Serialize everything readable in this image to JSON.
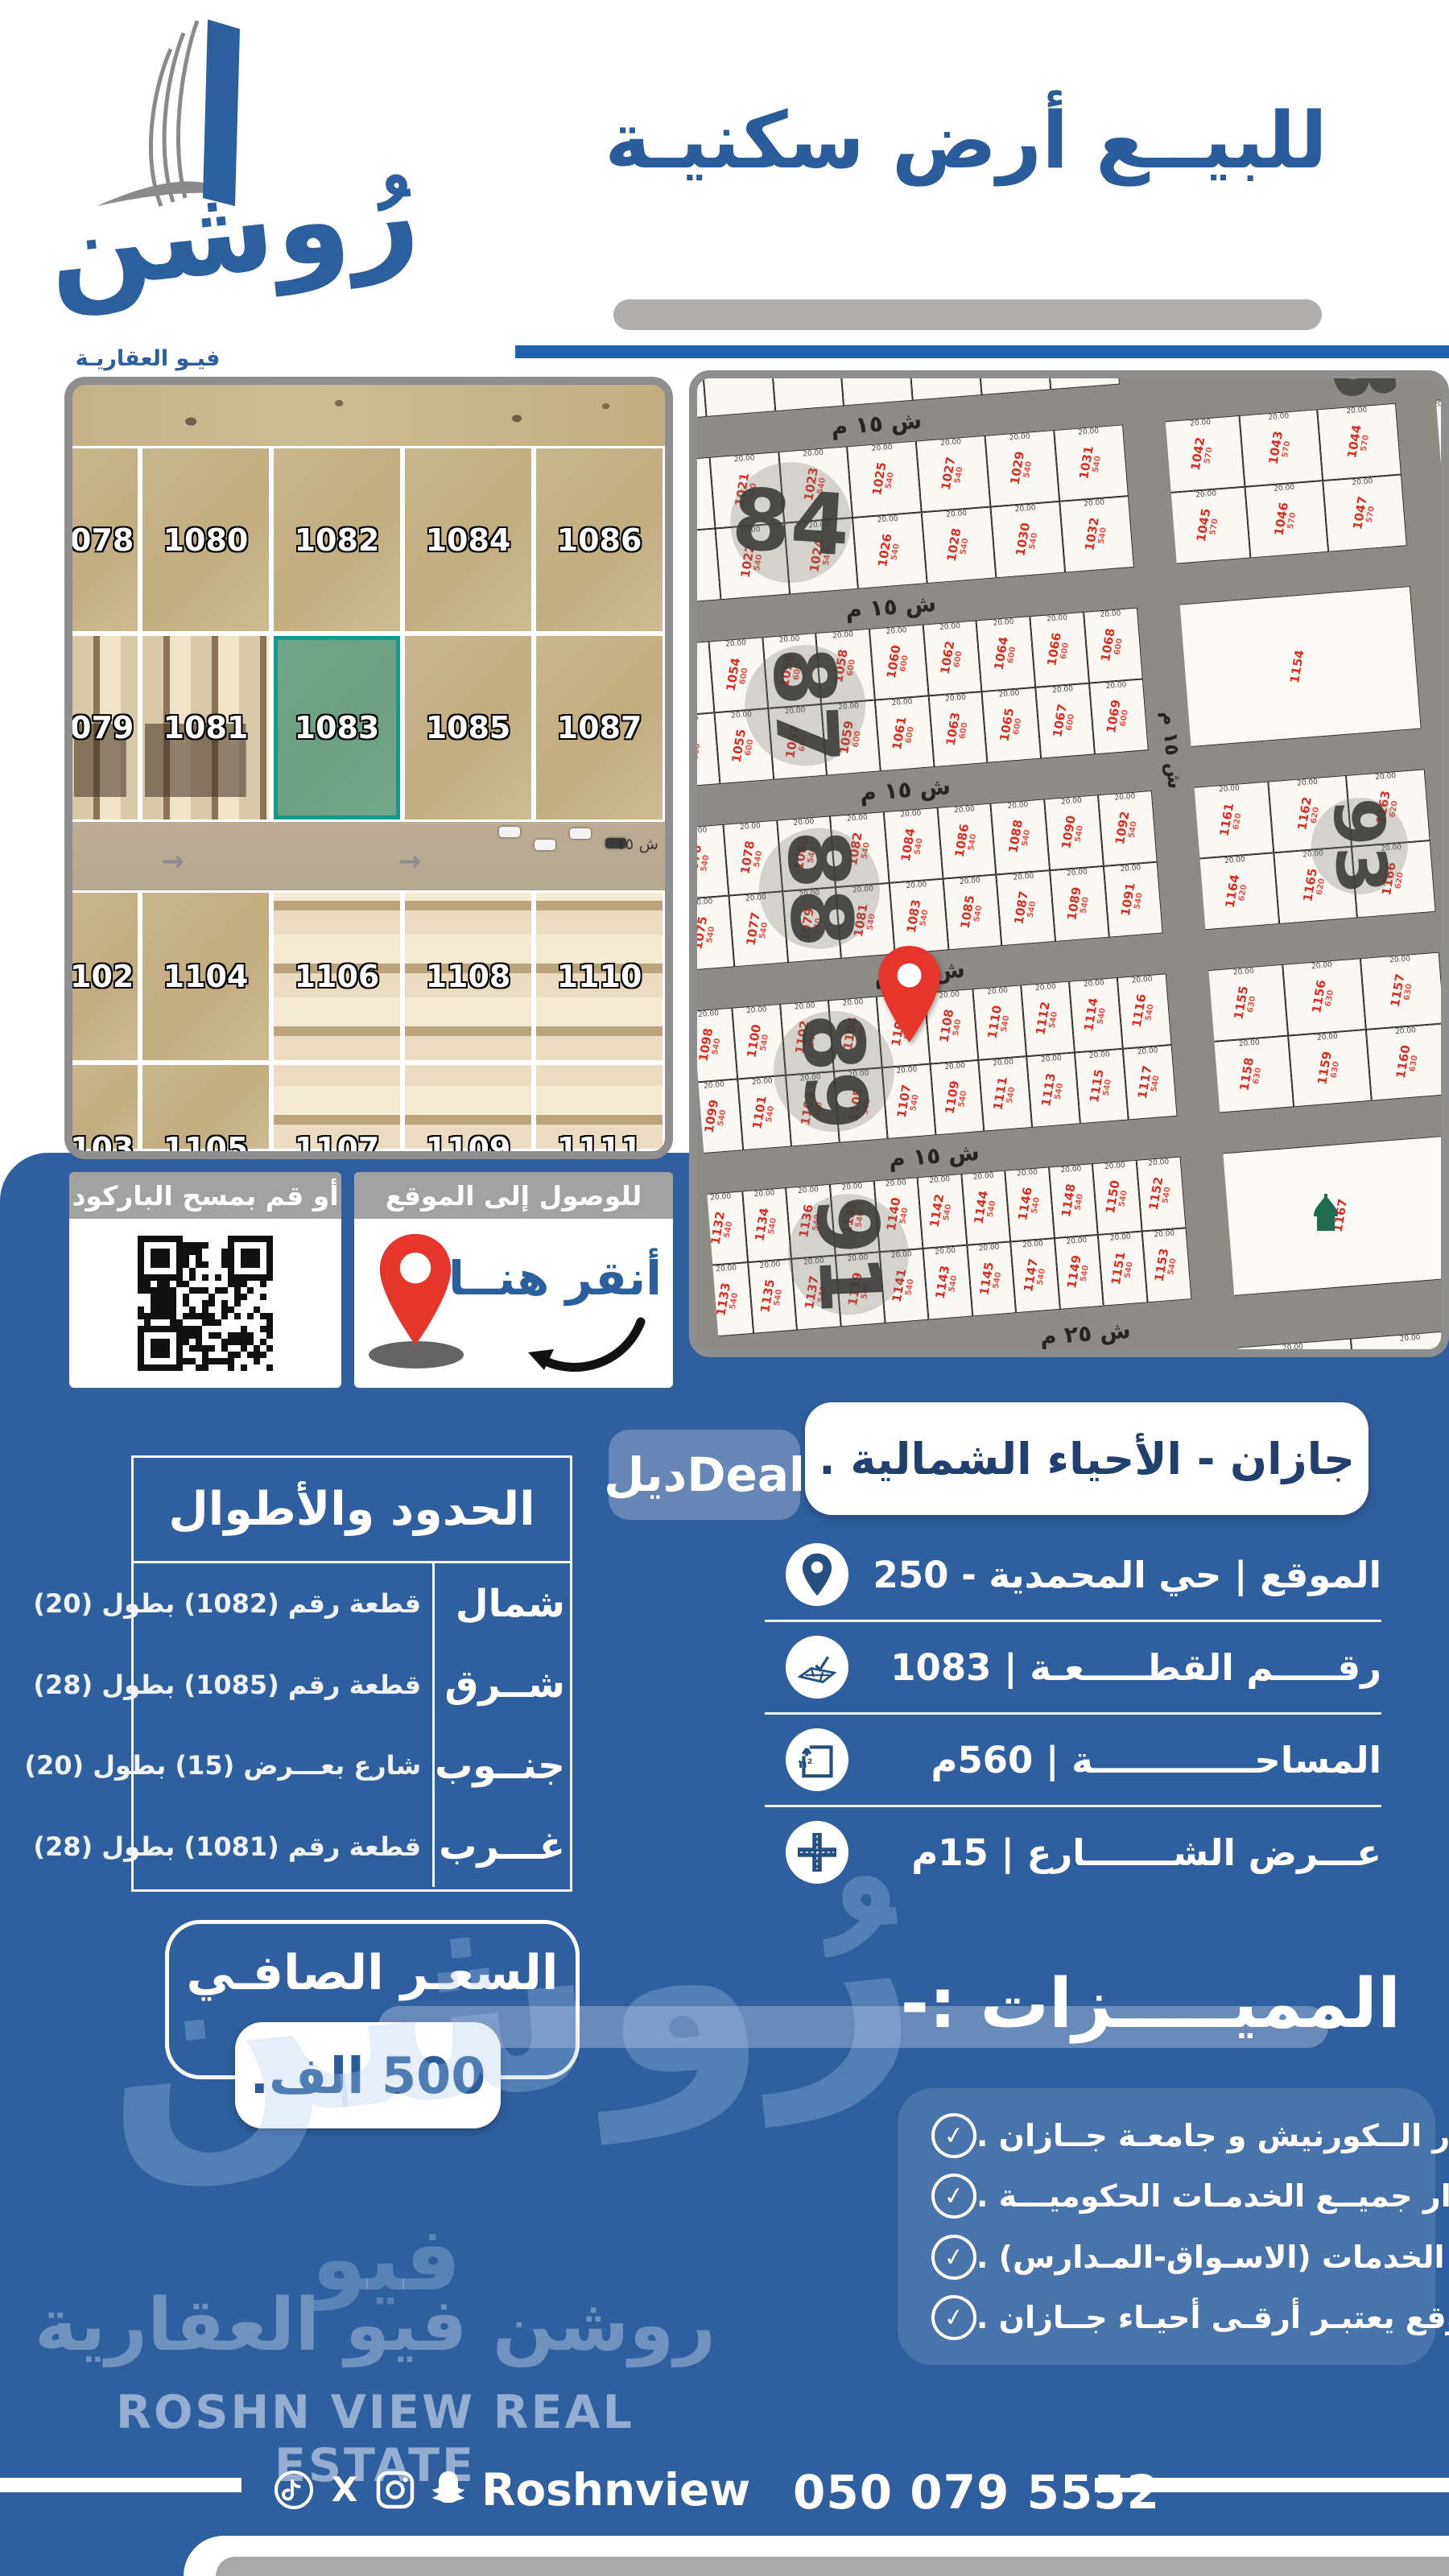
{
  "brand": {
    "logo_callig": "رُوشن",
    "logo_sub": "فيـو العقاريـة",
    "watermark_word": "فيو",
    "watermark_ar": "روشن فيو العقارية",
    "watermark_en": "ROSHN VIEW REAL ESTATE"
  },
  "colors": {
    "main_blue": "#2f5f9f",
    "title_blue": "#2a5c9c",
    "accent_line": "#2161ac",
    "highlight_teal": "#13988a",
    "parcel_red": "#d92f23",
    "pin_red": "#e8352b",
    "mosque_green": "#1e6b50"
  },
  "header": {
    "title": "للبيــع أرض سكنيـة"
  },
  "satellite_map": {
    "rows": [
      [
        "1078",
        "1080",
        "1082",
        "1084",
        "1086"
      ],
      [
        "1079",
        "1081",
        "1083",
        "1085",
        "1087"
      ],
      [
        "1102",
        "1104",
        "1106",
        "1108",
        "1110"
      ],
      [
        "1103",
        "1105",
        "1107",
        "1109",
        "1111"
      ]
    ],
    "highlighted": "1083",
    "road_label": "ش ١٥",
    "arrow_glyph": "→"
  },
  "plat_map": {
    "street_15": "ش ١٥ م",
    "street_25": "ش ٢٥ م",
    "vertical_street": "ش ١٥ م",
    "corner_block": "83",
    "dim_label": "20.00",
    "edge_parcels": [
      "1206",
      "1207",
      "1234"
    ],
    "mosque_parcel": "1167",
    "strips": [
      {
        "block": "84",
        "rot": 8,
        "area": "540",
        "top": [
          "1019",
          "1021",
          "1023",
          "1025",
          "1027",
          "1029",
          "1031"
        ],
        "bottom": [
          "1020",
          "1022",
          "1024",
          "1026",
          "1028",
          "1030",
          "1032"
        ],
        "right_type": "grid",
        "right": [
          "1042",
          "1043",
          "1044",
          "1045",
          "1046",
          "1047"
        ],
        "right_area": "570"
      },
      {
        "block": "87",
        "rot": 92,
        "area": "600",
        "top": [
          "1052",
          "1054",
          "1056",
          "1058",
          "1060",
          "1062",
          "1064",
          "1066",
          "1068"
        ],
        "bottom": [
          "1053",
          "1055",
          "1057",
          "1059",
          "1061",
          "1063",
          "1065",
          "1067",
          "1069"
        ],
        "right_type": "big",
        "right_label": "1154"
      },
      {
        "block": "88",
        "rot": 92,
        "area": "540",
        "top": [
          "1076",
          "1078",
          "1080",
          "1082",
          "1084",
          "1086",
          "1088",
          "1090",
          "1092"
        ],
        "bottom": [
          "1075",
          "1077",
          "1079",
          "1081",
          "1083",
          "1085",
          "1087",
          "1089",
          "1091"
        ],
        "right_type": "block",
        "right_block": "93",
        "right": [
          "1161",
          "1162",
          "1163",
          "1164",
          "1165",
          "1166"
        ],
        "right_area": "620"
      },
      {
        "block": "89",
        "rot": 92,
        "area": "540",
        "top": [
          "1098",
          "1100",
          "1102",
          "1104",
          "1106",
          "1108",
          "1110",
          "1112",
          "1114",
          "1116"
        ],
        "bottom": [
          "1099",
          "1101",
          "1103",
          "1105",
          "1107",
          "1109",
          "1111",
          "1113",
          "1115",
          "1117"
        ],
        "right_type": "grid",
        "right": [
          "1155",
          "1156",
          "1157",
          "1158",
          "1159",
          "1160"
        ],
        "right_area": "630"
      },
      {
        "block": "91",
        "rot": 92,
        "area": "540",
        "top": [
          "1132",
          "1134",
          "1136",
          "1138",
          "1140",
          "1142",
          "1144",
          "1146",
          "1148",
          "1150",
          "1152"
        ],
        "bottom": [
          "1133",
          "1135",
          "1137",
          "1139",
          "1141",
          "1143",
          "1145",
          "1147",
          "1149",
          "1151",
          "1153"
        ],
        "right_type": "mosque",
        "right_label": "1167"
      },
      {
        "block": "05",
        "rot": 92,
        "area": "475",
        "top": [
          "1334",
          "1336",
          "1338",
          "1340",
          "1342",
          "1344",
          "1346",
          "1348",
          "1350",
          "1352",
          "1354",
          "1356"
        ],
        "bottom": [],
        "right_type": "grid2",
        "right": [
          "1358",
          "1359"
        ],
        "right_area": "475"
      }
    ]
  },
  "qr_card": {
    "title": "أو قم بمسح الباركود"
  },
  "location_card": {
    "title": "للوصول إلى الموقع",
    "click_here": "أنقر هنــا"
  },
  "region_pill": {
    "text": "جازان - الأحياء الشمالية ."
  },
  "deal_badge": {
    "text": "ديلDeal"
  },
  "details": [
    {
      "icon": "location-pin-icon",
      "label": "الموقع | حي المحمدية - 250"
    },
    {
      "icon": "plot-number-icon",
      "label": "رقـــــم القطـــــعـة | 1083"
    },
    {
      "icon": "area-icon",
      "label": "المساحـــــــــــــة | 560م"
    },
    {
      "icon": "street-width-icon",
      "label": "عـــرض الشـــــــارع | 15م"
    }
  ],
  "boundaries": {
    "title": "الحدود والأطوال",
    "rows": [
      {
        "dir": "شمال",
        "value": "قطعة رقم (1082) بطول (20)"
      },
      {
        "dir": "شــرق",
        "value": "قطعة رقم (1085) بطول (28)"
      },
      {
        "dir": "جنــوب",
        "value": "شارع بعـــرض (15) بطول (20)"
      },
      {
        "dir": "غـــرب",
        "value": "قطعة رقم (1081) بطول (28)"
      }
    ]
  },
  "price": {
    "title": "السعـر الصافـي",
    "value": "500 الف."
  },
  "features": {
    "title": "المميـــــزات :-",
    "items": [
      "بجــوار الــكورنيش و جامعـة جــازان .",
      "بجوار جميــع الخدمـات الحكوميـــة .",
      "بجوار الخدمات (الاسـواق-المـدارس) .",
      "الموقع يعتبـر أرقـى أحيـاء جــازان ."
    ]
  },
  "footer": {
    "social_icons": [
      "tiktok-icon",
      "x-icon",
      "instagram-icon",
      "snapchat-icon"
    ],
    "handle": "Roshnview",
    "phone": "050 079 5552"
  }
}
